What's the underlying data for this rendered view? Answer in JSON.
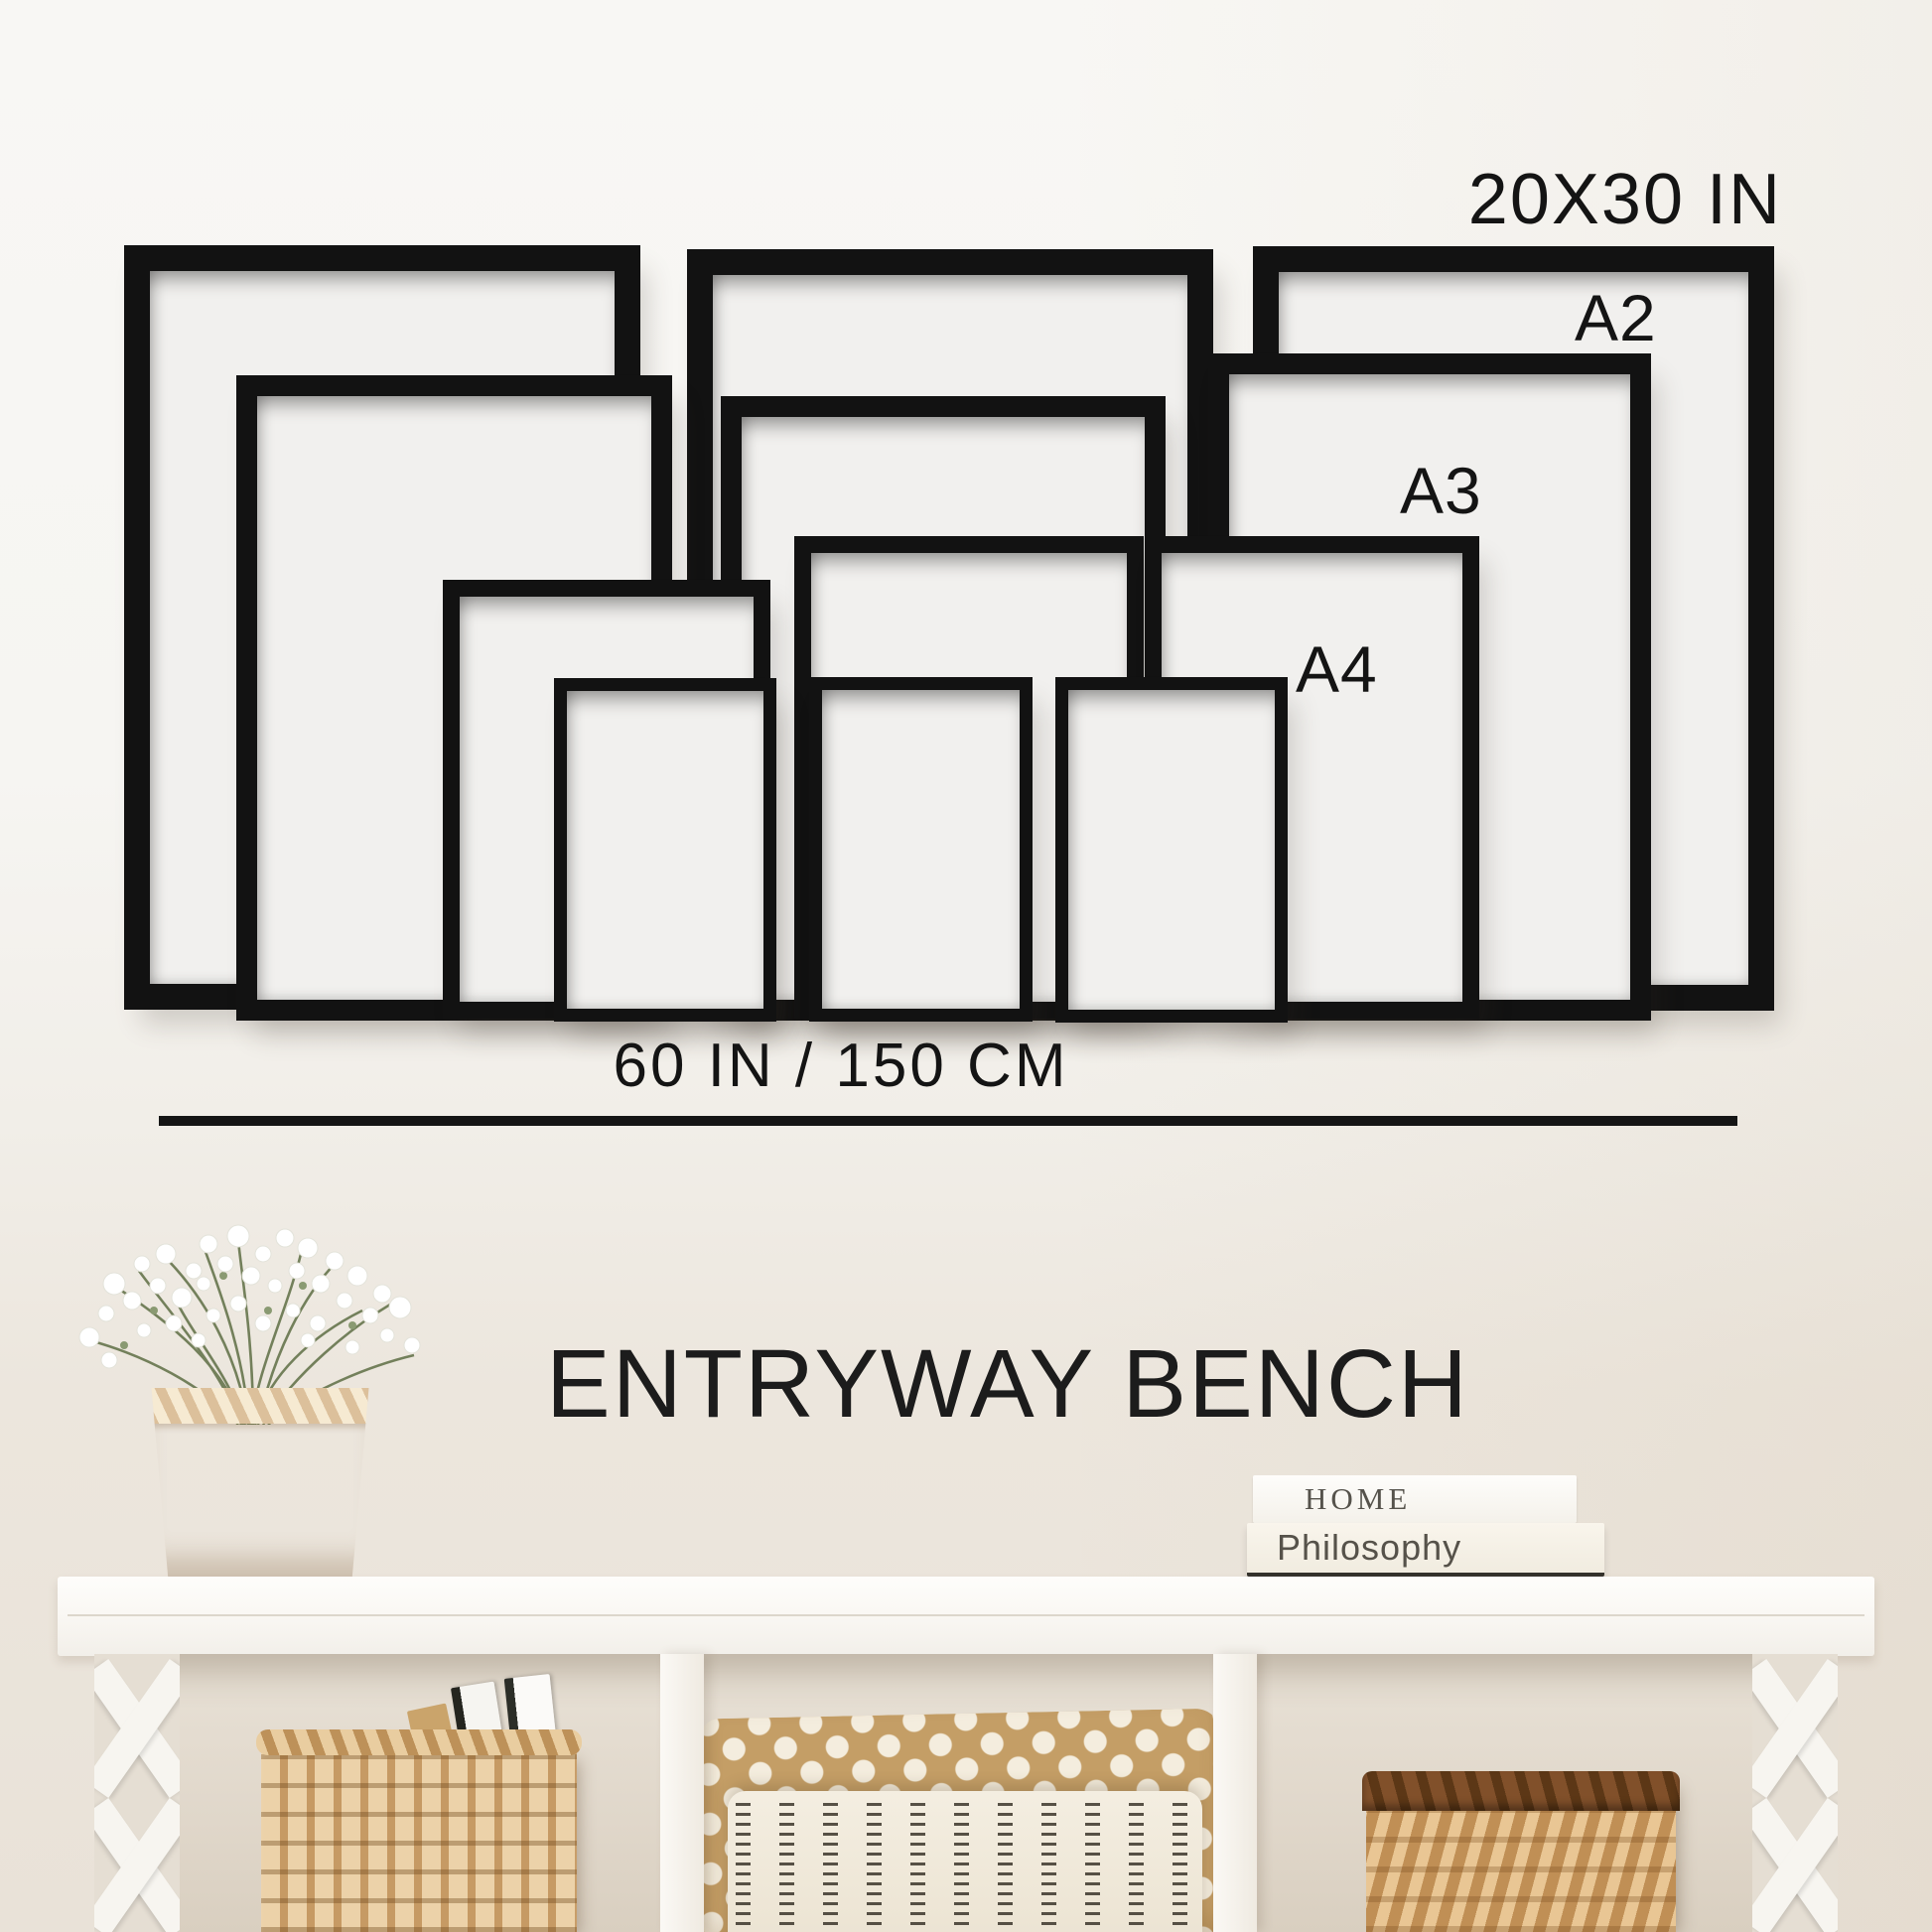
{
  "labels": {
    "size_large": "20X30 IN",
    "size_a2": "A2",
    "size_a3": "A3",
    "size_a4": "A4",
    "bench_width": "60 IN / 150 CM"
  },
  "title": "ENTRYWAY BENCH",
  "books": {
    "top": "HOME",
    "bottom": "Philosophy"
  },
  "frames": [
    {
      "size_label": "20X30 IN",
      "count": 3
    },
    {
      "size_label": "A2",
      "count": 3
    },
    {
      "size_label": "A3",
      "count": 3
    },
    {
      "size_label": "A4",
      "count": 3
    }
  ],
  "colors": {
    "frame_black": "#121212",
    "text": "#141414",
    "wall_top": "#f8f7f4",
    "wall_bottom": "#e9e2d8",
    "wicker_tan": "#d2b189",
    "pillow_polka": "#c49e66",
    "pillow_stripe": "#f0e9db"
  }
}
